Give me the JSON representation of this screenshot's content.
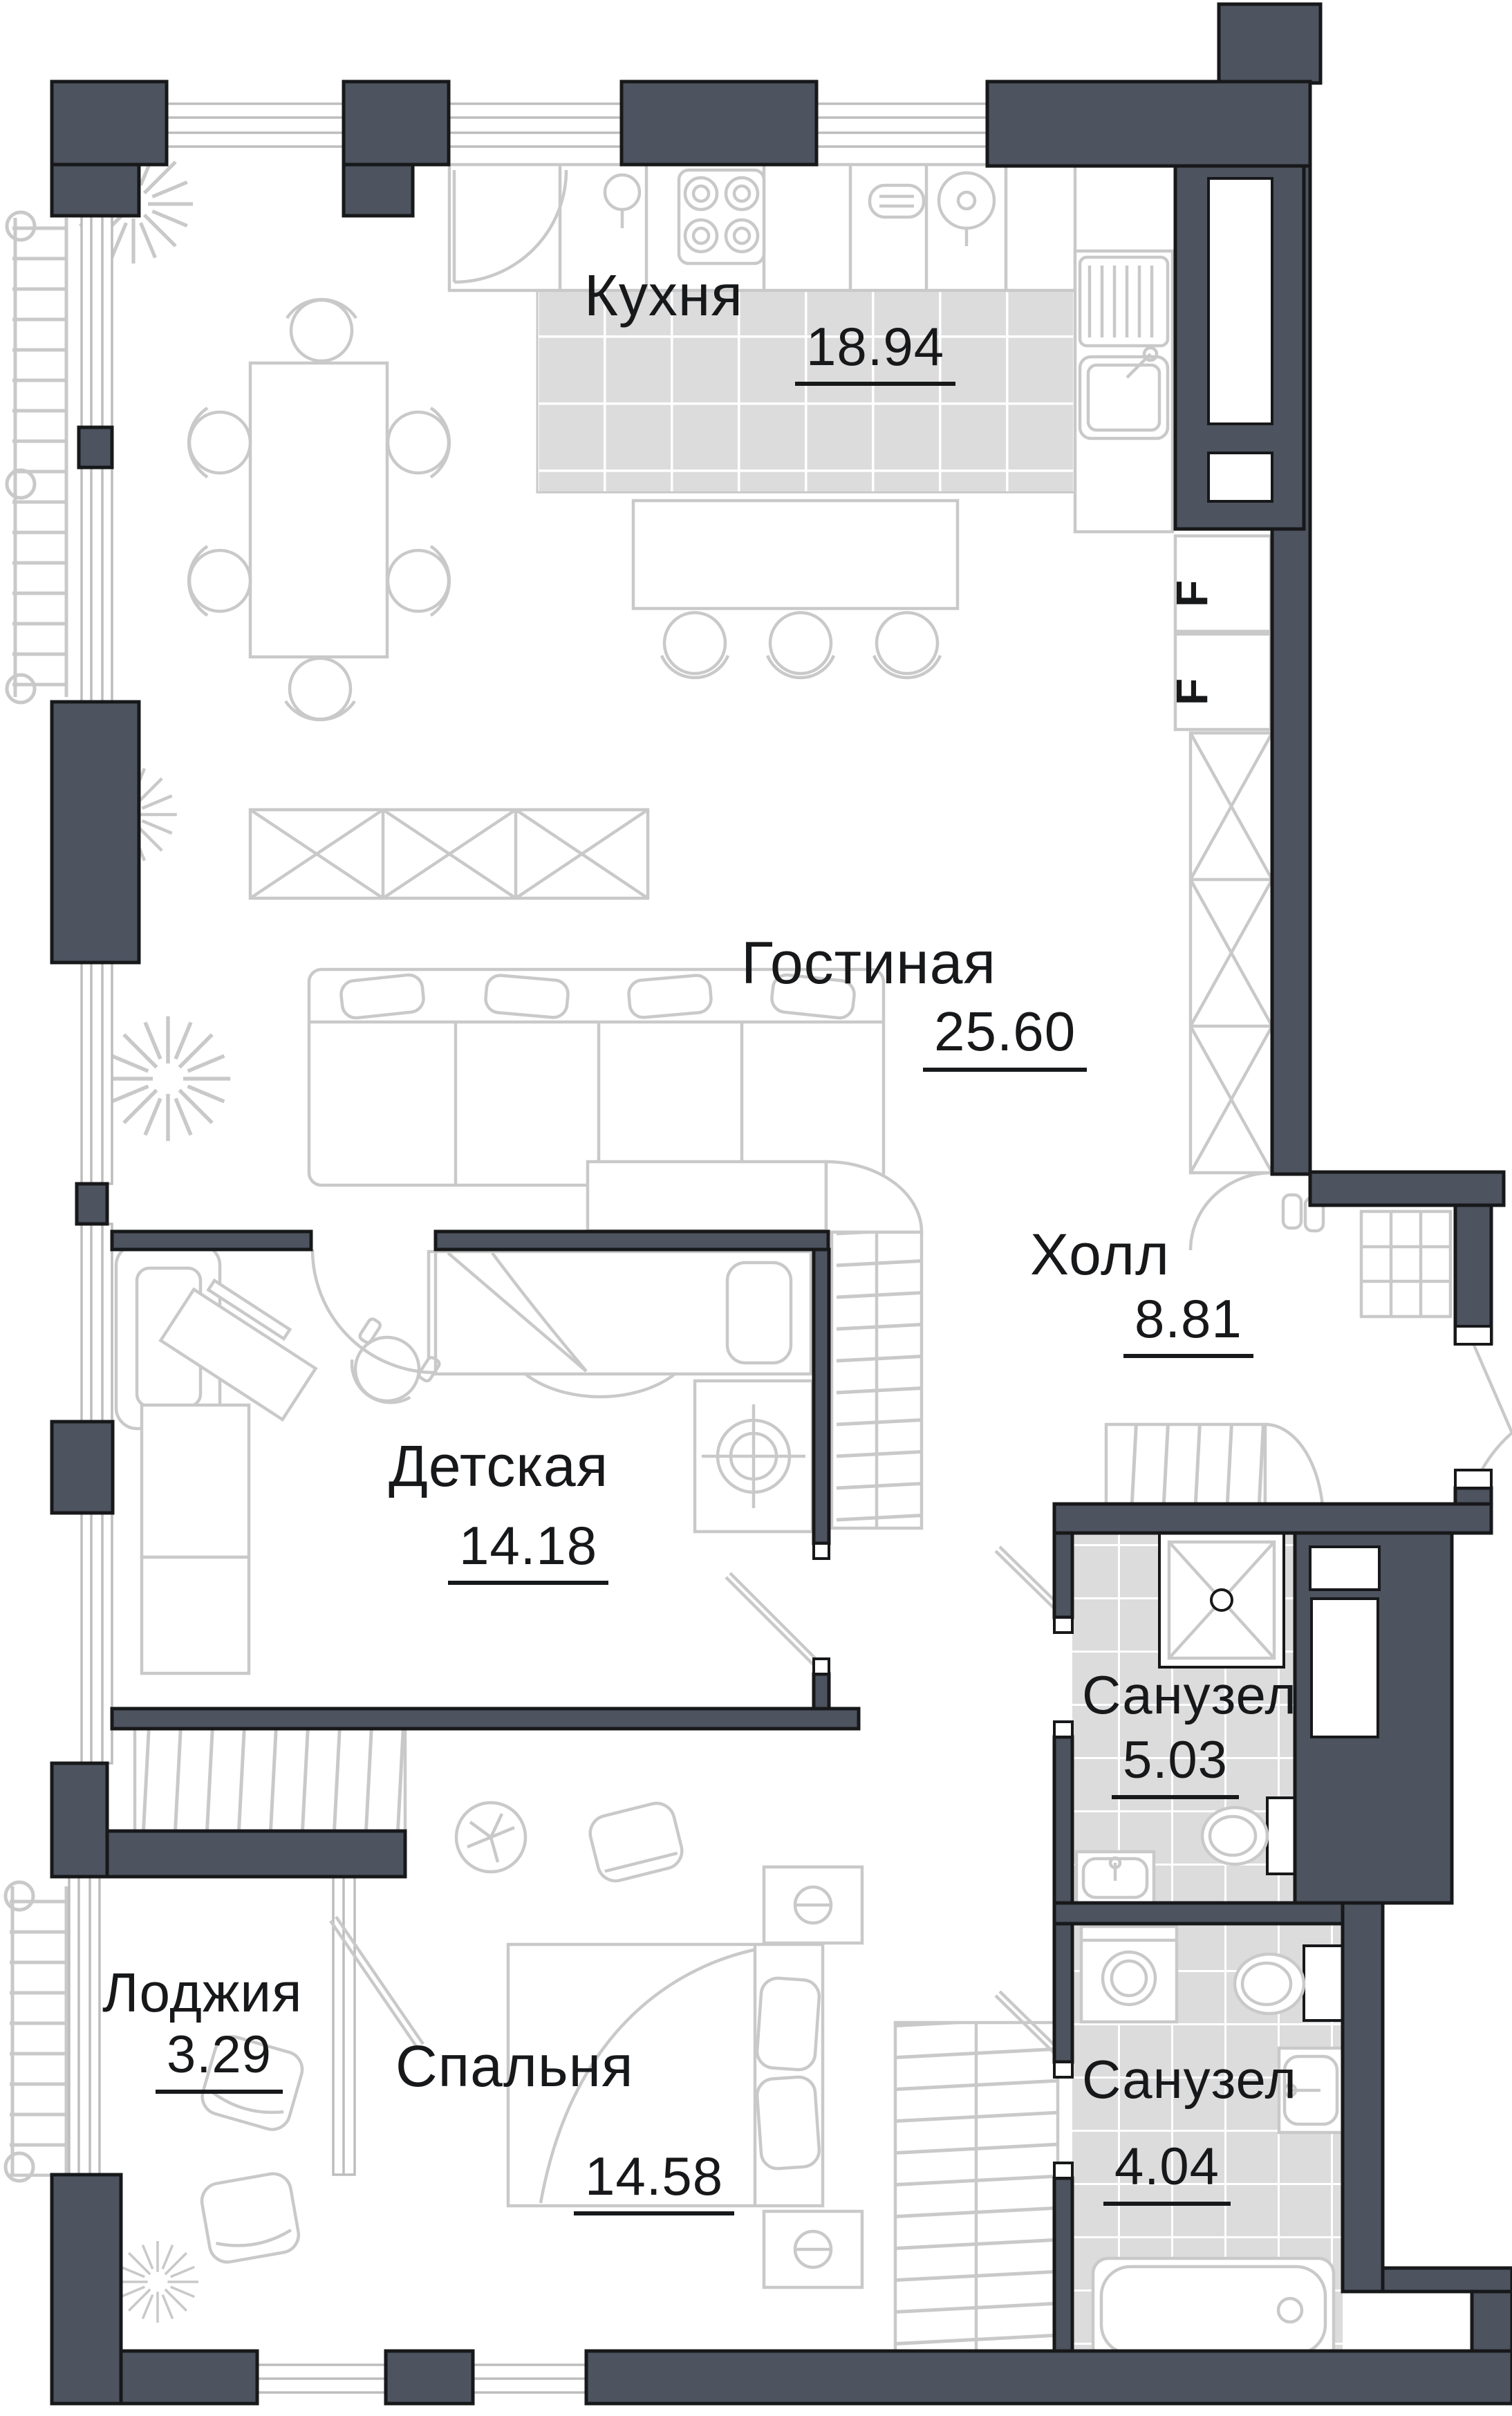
{
  "plan": {
    "wall_color": "#4d535f",
    "furniture_line_color": "#c9c9c9",
    "tile_color": "#dcdcdc",
    "text_color": "#17181a"
  },
  "rooms": [
    {
      "id": "kitchen",
      "name": "Кухня",
      "area": "18.94"
    },
    {
      "id": "living",
      "name": "Гостиная",
      "area": "25.60"
    },
    {
      "id": "hall",
      "name": "Холл",
      "area": "8.81"
    },
    {
      "id": "children",
      "name": "Детская",
      "area": "14.18"
    },
    {
      "id": "bathroom-1",
      "name": "Санузел",
      "area": "5.03"
    },
    {
      "id": "loggia",
      "name": "Лоджия",
      "area": "3.29"
    },
    {
      "id": "bedroom",
      "name": "Спальня",
      "area": "14.58"
    },
    {
      "id": "bathroom-2",
      "name": "Санузел",
      "area": "4.04"
    }
  ],
  "appliance_marks": {
    "fridge_1": "F",
    "fridge_2": "F"
  }
}
